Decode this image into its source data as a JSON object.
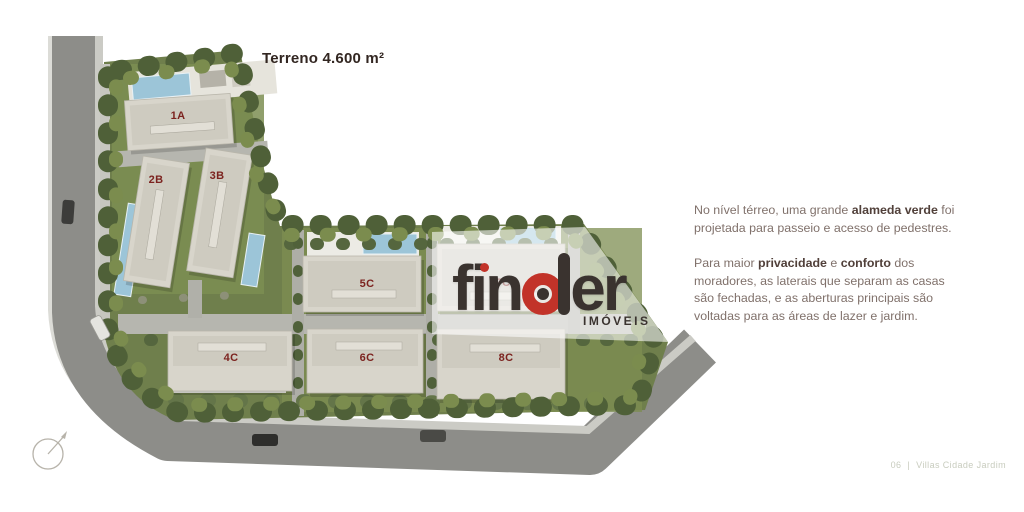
{
  "page": {
    "terreno_label": "Terreno 4.600 m²",
    "footer": {
      "page_number": "06",
      "separator": "|",
      "title": "Villas Cidade Jardim"
    }
  },
  "plan": {
    "buildings": [
      {
        "id": "1A"
      },
      {
        "id": "2B"
      },
      {
        "id": "3B"
      },
      {
        "id": "5C"
      },
      {
        "id": "7C"
      },
      {
        "id": "4C"
      },
      {
        "id": "6C"
      },
      {
        "id": "8C"
      }
    ]
  },
  "watermark": {
    "brand_fin": "fin",
    "brand_er": "er",
    "tagline": "IMÓVEIS"
  },
  "description": {
    "p1": {
      "t1": "No nível térreo, uma grande ",
      "b1": "alameda verde",
      "t2": " foi projetada para passeio e acesso de pedestres."
    },
    "p2": {
      "t1": "Para maior ",
      "b1": "privacidade",
      "t2": " e ",
      "b2": "conforto",
      "t3": " dos moradores, as laterais que separam as casas são fechadas, e as aberturas principais são voltadas para as áreas de lazer e jardim."
    }
  },
  "colors": {
    "brand-red": "#c23329",
    "logo-dark": "#3a332f",
    "label-maroon": "#7c231f",
    "body-text": "#80716b",
    "body-text-bold": "#51403a",
    "footer-text": "#c8ccbe",
    "terreno-text": "#322621"
  }
}
